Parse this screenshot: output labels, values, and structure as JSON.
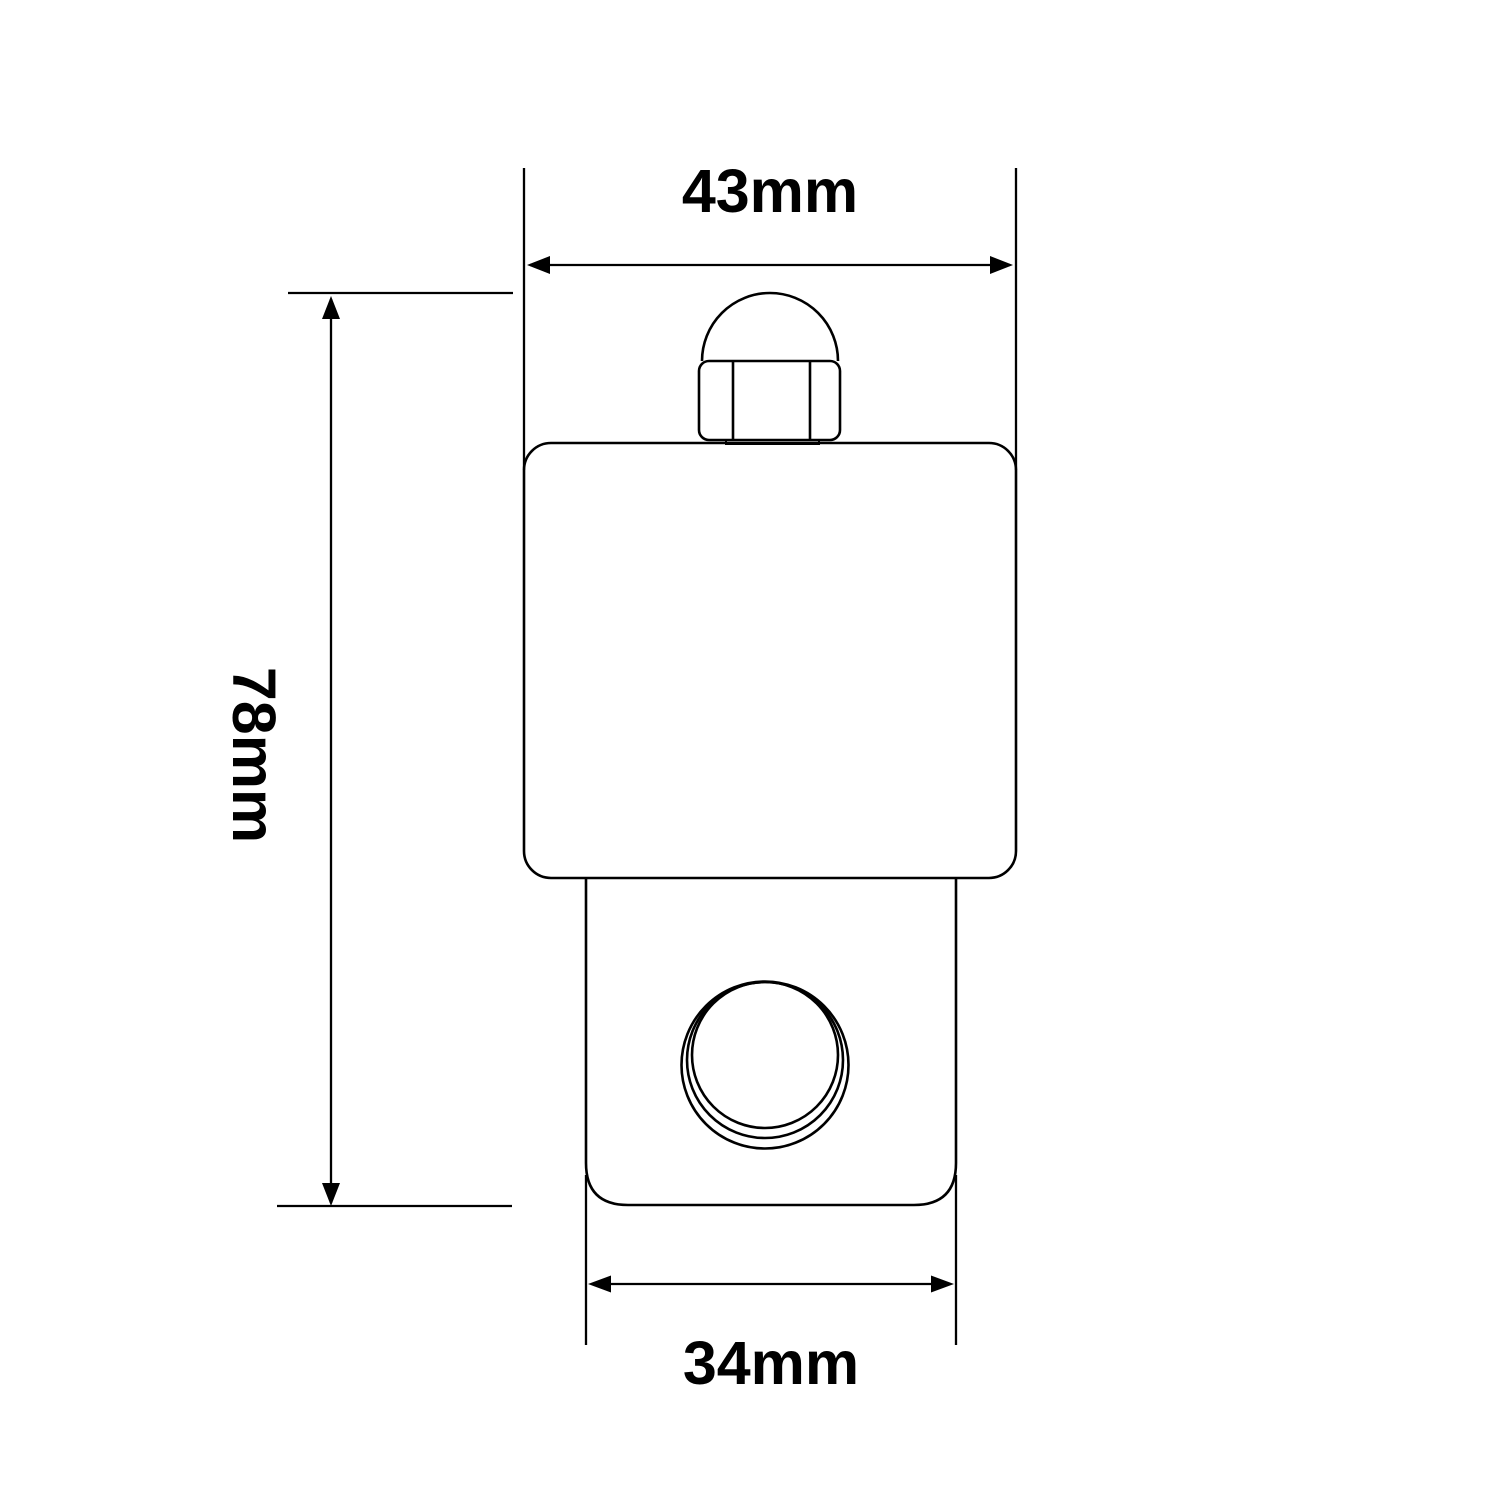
{
  "drawing": {
    "labels": {
      "width_top": "43mm",
      "height_left": "78mm",
      "width_bottom": "34mm"
    },
    "stroke_color": "#000000",
    "background_color": "#ffffff"
  }
}
